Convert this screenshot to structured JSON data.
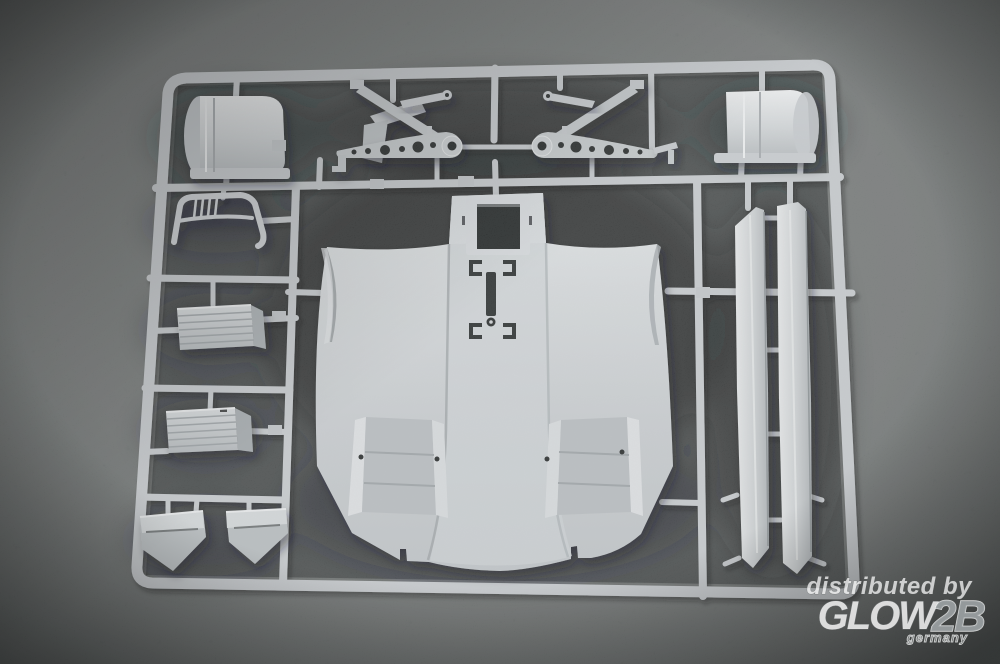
{
  "scene": {
    "description": "Product photo: injection-molded model kit sprue (light grey styrene) lying on dark grey carpet",
    "parts": [
      {
        "name": "sprue-frame",
        "label": "sprue runner frame"
      },
      {
        "name": "drum-part-top-left",
        "label": "cylindrical drum part"
      },
      {
        "name": "support-bracket-part",
        "label": "angled bracket part"
      },
      {
        "name": "windshield-frame-part",
        "label": "curved frame part with slats"
      },
      {
        "name": "rocker-beam-left",
        "label": "drilled rocker beam, left"
      },
      {
        "name": "rocker-beam-right",
        "label": "drilled rocker beam, right"
      },
      {
        "name": "lever-part-left",
        "label": "small lever part"
      },
      {
        "name": "lever-part-right",
        "label": "small lever part"
      },
      {
        "name": "drum-part-top-right",
        "label": "cylindrical drum part"
      },
      {
        "name": "hull-roof-part",
        "label": "large hull roof / fender moulding"
      },
      {
        "name": "grille-part-upper",
        "label": "ribbed grille plate"
      },
      {
        "name": "grille-part-lower",
        "label": "ribbed grille plate"
      },
      {
        "name": "mud-flap-part-left",
        "label": "wedge mud-flap part"
      },
      {
        "name": "mud-flap-part-right",
        "label": "wedge mud-flap part"
      },
      {
        "name": "side-skirt-part-inner",
        "label": "long side-skirt strip"
      },
      {
        "name": "side-skirt-part-outer",
        "label": "long side-skirt strip"
      }
    ]
  },
  "watermark": {
    "line1": "distributed by",
    "logo": "GLOW",
    "logo_suffix": "2B",
    "sublabel": "germany"
  },
  "colors": {
    "carpet_outer": "#6e7170",
    "carpet_inner": "#4d5151",
    "carpet_shadow": "#1f2324",
    "plastic_mid": "#c7cbce",
    "plastic_light": "#e9ebec",
    "plastic_dark": "#9aa0a3",
    "hole_dark": "#26292a",
    "watermark_white": "#ffffff",
    "watermark_gray": "#9ba1a3"
  }
}
